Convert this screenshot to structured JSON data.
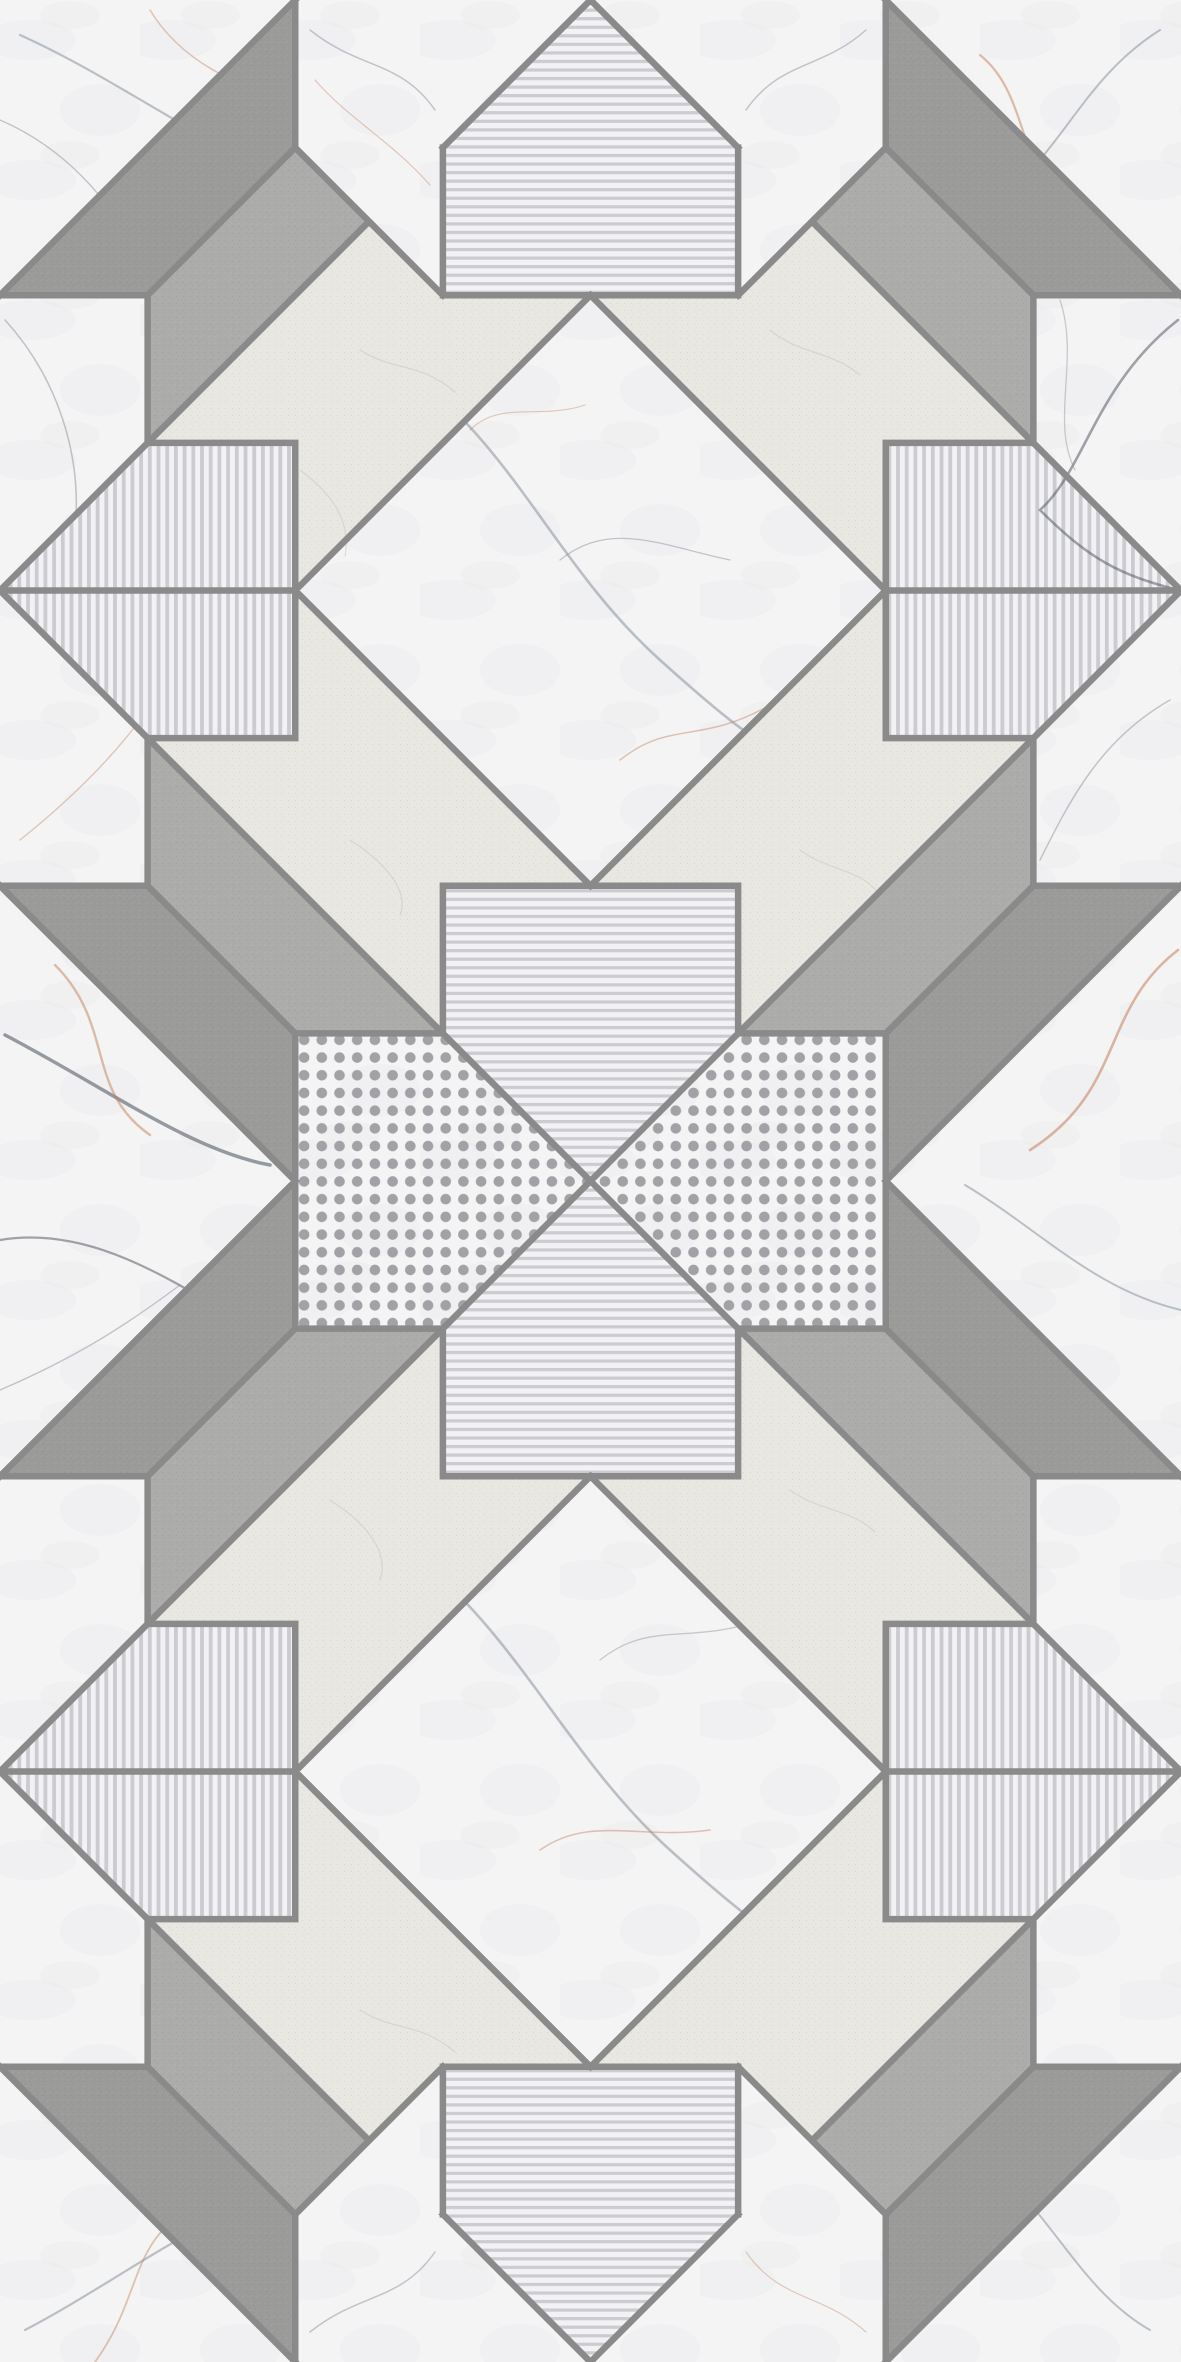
{
  "meta": {
    "description": "Geometric patchwork ceramic tile design: marble, greige stone, speckled gray bands, stripes and dots",
    "canvas": {
      "width": 1181,
      "height": 2362
    }
  },
  "palette": {
    "border": "#8a8a8a",
    "marble_white": "#f4f4f5",
    "stone_dark": "#9b9b9a",
    "stone_medium": "#acacab",
    "greige": "#e9e7e1",
    "stripe_bg": "#f2f2f4",
    "stripe_bar": "#cbcbd1",
    "dot_fill": "#a2a2a6",
    "vein_slate": "#7e8a95",
    "vein_dark": "#474f59",
    "vein_orange": "#c4805a",
    "crack": "#d3cfc4"
  },
  "pattern": {
    "unit": 147.625,
    "border_width": 6.5,
    "textures": {
      "white": {
        "fill": "#f4f4f5",
        "overlays": [
          "marble"
        ]
      },
      "dark": {
        "fill": "#9b9b9a",
        "overlays": [
          "grain"
        ]
      },
      "medium": {
        "fill": "#acacab",
        "overlays": [
          "grain"
        ]
      },
      "greige": {
        "fill": "#e9e7e1",
        "overlays": [
          "grain"
        ]
      },
      "hstripes": {
        "fill": "stripeH",
        "overlays": []
      },
      "vstripes": {
        "fill": "stripeV",
        "overlays": []
      },
      "dots": {
        "fill": "#f4f4f5",
        "overlays": [
          "marble",
          "dotsP"
        ]
      }
    },
    "defs": {
      "stripeH": {
        "w": 10,
        "h": 8.55,
        "bar": [
          0,
          0,
          10,
          3.2
        ]
      },
      "stripeV": {
        "w": 8.7,
        "h": 10,
        "bar": [
          0,
          0,
          3.8,
          10
        ]
      },
      "dotsP": {
        "size": 17.7,
        "r": 5.3,
        "x": 295.25,
        "y": 1031
      },
      "grain": {
        "size": 7,
        "cells": [
          [
            1,
            2,
            "rgba(30,30,30,0.085)"
          ],
          [
            5,
            0,
            "rgba(255,255,255,0.10)"
          ],
          [
            3,
            5,
            "rgba(30,30,30,0.05)"
          ],
          [
            0,
            6,
            "rgba(255,255,255,0.07)"
          ]
        ]
      },
      "marble": {
        "w": 140,
        "h": 140,
        "blobs": [
          [
            30,
            40,
            46,
            20,
            "rgba(158,168,178,0.055)"
          ],
          [
            100,
            110,
            40,
            26,
            "rgba(158,168,178,0.045)"
          ],
          [
            70,
            15,
            30,
            14,
            "rgba(190,160,140,0.04)"
          ]
        ]
      }
    },
    "regions": [
      {
        "name": "corner-marble",
        "tex": "white",
        "mirror": true,
        "pts": [
          [
            0,
            0
          ],
          [
            2,
            0
          ],
          [
            0,
            2
          ]
        ]
      },
      {
        "name": "dark-band-top",
        "tex": "dark",
        "mirror": true,
        "pts": [
          [
            2,
            0
          ],
          [
            2,
            1
          ],
          [
            1,
            2
          ],
          [
            0,
            2
          ]
        ]
      },
      {
        "name": "marble-flank-top",
        "tex": "white",
        "mirror": true,
        "pts": [
          [
            2,
            0
          ],
          [
            4,
            0
          ],
          [
            3,
            1
          ],
          [
            3,
            2
          ],
          [
            2,
            1
          ]
        ]
      },
      {
        "name": "pentagon-top",
        "tex": "hstripes",
        "mirror": false,
        "pts": [
          [
            4,
            0
          ],
          [
            5,
            1
          ],
          [
            5,
            2
          ],
          [
            3,
            2
          ],
          [
            3,
            1
          ]
        ]
      },
      {
        "name": "medium-band-top",
        "tex": "medium",
        "mirror": true,
        "pts": [
          [
            2,
            1
          ],
          [
            2.5,
            1.5
          ],
          [
            1,
            3
          ],
          [
            1,
            2
          ]
        ]
      },
      {
        "name": "marble-edge-upper",
        "tex": "white",
        "mirror": true,
        "pts": [
          [
            0,
            2
          ],
          [
            1,
            2
          ],
          [
            1,
            3
          ],
          [
            0,
            4
          ]
        ]
      },
      {
        "name": "pentagon-side",
        "tex": "vstripes",
        "mirror": true,
        "pts": [
          [
            0,
            4
          ],
          [
            1,
            3
          ],
          [
            2,
            3
          ],
          [
            2,
            5
          ],
          [
            1,
            5
          ]
        ]
      },
      {
        "name": "greige-chevron-top",
        "tex": "greige",
        "mirror": true,
        "pts": [
          [
            2.5,
            1.5
          ],
          [
            3,
            2
          ],
          [
            4,
            2
          ],
          [
            2,
            4
          ],
          [
            2,
            3
          ],
          [
            1,
            3
          ]
        ]
      },
      {
        "name": "marble-diamond",
        "tex": "white",
        "mirror": false,
        "pts": [
          [
            4,
            2
          ],
          [
            6,
            4
          ],
          [
            4,
            6
          ],
          [
            2,
            4
          ]
        ]
      },
      {
        "name": "marble-edge-lower",
        "tex": "white",
        "mirror": true,
        "pts": [
          [
            0,
            6
          ],
          [
            1,
            6
          ],
          [
            1,
            5
          ],
          [
            0,
            4
          ]
        ]
      },
      {
        "name": "medium-band-bot",
        "tex": "medium",
        "mirror": true,
        "pts": [
          [
            1,
            5
          ],
          [
            3,
            7
          ],
          [
            2,
            7
          ],
          [
            1,
            6
          ]
        ]
      },
      {
        "name": "greige-chevron-bot",
        "tex": "greige",
        "mirror": true,
        "pts": [
          [
            1,
            5
          ],
          [
            2,
            5
          ],
          [
            2,
            4
          ],
          [
            4,
            6
          ],
          [
            3,
            6
          ],
          [
            3,
            7
          ]
        ]
      },
      {
        "name": "dark-band-bot",
        "tex": "dark",
        "mirror": true,
        "pts": [
          [
            2,
            8
          ],
          [
            2,
            7
          ],
          [
            1,
            6
          ],
          [
            0,
            6
          ]
        ]
      },
      {
        "name": "corner-marble-bot",
        "tex": "white",
        "mirror": true,
        "pts": [
          [
            0,
            6
          ],
          [
            2,
            8
          ],
          [
            0,
            8
          ]
        ]
      },
      {
        "name": "dotted-patch",
        "tex": "dots",
        "mirror": true,
        "pts": [
          [
            2,
            7
          ],
          [
            3,
            7
          ],
          [
            4,
            8
          ],
          [
            2,
            8
          ]
        ]
      },
      {
        "name": "pentagon-bottom",
        "tex": "hstripes",
        "mirror": false,
        "pts": [
          [
            4,
            8
          ],
          [
            5,
            7
          ],
          [
            5,
            6
          ],
          [
            3,
            6
          ],
          [
            3,
            7
          ]
        ]
      }
    ],
    "borders": {
      "verticals": [
        [
          2,
          0,
          1
        ],
        [
          3,
          1,
          2
        ],
        [
          1,
          2,
          3
        ],
        [
          2,
          3,
          5
        ],
        [
          1,
          5,
          6
        ],
        [
          3,
          6,
          7
        ],
        [
          2,
          7,
          8
        ]
      ],
      "horizontals": [
        [
          2,
          0,
          1
        ],
        [
          2,
          3,
          4
        ],
        [
          3,
          1,
          2
        ],
        [
          4,
          0,
          2
        ],
        [
          5,
          1,
          2
        ],
        [
          6,
          0,
          1
        ],
        [
          6,
          3,
          4
        ],
        [
          7,
          2,
          3
        ]
      ],
      "diagonals": [
        [
          [
            2,
            0
          ],
          [
            0,
            2
          ]
        ],
        [
          [
            2,
            1
          ],
          [
            1,
            2
          ]
        ],
        [
          [
            4,
            0
          ],
          [
            3,
            1
          ]
        ],
        [
          [
            2.5,
            1.5
          ],
          [
            0,
            4
          ]
        ],
        [
          [
            4,
            2
          ],
          [
            2,
            4
          ]
        ],
        [
          [
            2,
            1
          ],
          [
            3,
            2
          ]
        ],
        [
          [
            2,
            4
          ],
          [
            4,
            6
          ]
        ],
        [
          [
            0,
            4
          ],
          [
            4,
            8
          ]
        ],
        [
          [
            1,
            6
          ],
          [
            2,
            7
          ]
        ],
        [
          [
            0,
            6
          ],
          [
            2,
            8
          ]
        ]
      ]
    },
    "clips": {
      "cornerTL": [
        [
          0,
          0
        ],
        [
          295.25,
          0
        ],
        [
          0,
          295.25
        ]
      ],
      "cornerTR": [
        [
          1181,
          0
        ],
        [
          885.75,
          0
        ],
        [
          1181,
          295.25
        ]
      ],
      "diamondTop": [
        [
          590.5,
          295.25
        ],
        [
          885.75,
          590.5
        ],
        [
          590.5,
          885.75
        ],
        [
          295.25,
          590.5
        ]
      ],
      "leftSeam": [
        [
          0,
          885.75
        ],
        [
          295.25,
          1181
        ],
        [
          0,
          1476.25
        ]
      ],
      "rightSeam": [
        [
          1181,
          885.75
        ],
        [
          885.75,
          1181
        ],
        [
          1181,
          1476.25
        ]
      ],
      "leftMid": [
        [
          0,
          295.25
        ],
        [
          147.6,
          295.25
        ],
        [
          147.6,
          442.9
        ],
        [
          0,
          590.5
        ],
        [
          147.6,
          738.1
        ],
        [
          147.6,
          885.75
        ],
        [
          0,
          885.75
        ]
      ],
      "rightMid": [
        [
          1181,
          295.25
        ],
        [
          1033.4,
          295.25
        ],
        [
          1033.4,
          442.9
        ],
        [
          885.75,
          590.5
        ],
        [
          1033.4,
          738.1
        ],
        [
          1033.4,
          885.75
        ],
        [
          1181,
          885.75
        ]
      ],
      "diamondBottom": [
        [
          590.5,
          1476.25
        ],
        [
          885.75,
          1771.5
        ],
        [
          590.5,
          2066.75
        ],
        [
          295.25,
          1771.5
        ]
      ],
      "cornerBL": [
        [
          0,
          2362
        ],
        [
          295.25,
          2362
        ],
        [
          0,
          2066.75
        ]
      ],
      "cornerBR": [
        [
          1181,
          2362
        ],
        [
          885.75,
          2362
        ],
        [
          1181,
          2066.75
        ]
      ]
    },
    "veins": [
      {
        "clip": "cornerTL",
        "d": "M 20 35 C 120 80 210 150 292 178",
        "c": "slate",
        "w": 2.2,
        "o": 0.5
      },
      {
        "clip": "cornerTL",
        "d": "M 0 120 C 70 150 120 210 150 278",
        "c": "slate",
        "w": 1.4,
        "o": 0.45
      },
      {
        "clip": "cornerTL",
        "d": "M 150 10 C 180 60 240 90 288 96",
        "c": "orange",
        "w": 1.6,
        "o": 0.4
      },
      {
        "clip": "cornerTR",
        "d": "M 1160 30 C 1080 80 1060 160 990 205",
        "c": "slate",
        "w": 2.0,
        "o": 0.5
      },
      {
        "clip": "cornerTR",
        "d": "M 980 55 C 1030 95 1015 170 1075 215",
        "c": "orange",
        "w": 2.2,
        "o": 0.5
      },
      {
        "clip": "diamondTop",
        "d": "M 420 380 C 520 460 560 570 660 660 S 760 740 800 760",
        "c": "slate",
        "w": 2.6,
        "o": 0.5
      },
      {
        "clip": "diamondTop",
        "d": "M 560 560 C 610 520 660 545 730 560",
        "c": "slate",
        "w": 1.3,
        "o": 0.45
      },
      {
        "clip": "diamondTop",
        "d": "M 620 760 C 670 720 700 745 770 705",
        "c": "orange",
        "w": 1.5,
        "o": 0.45
      },
      {
        "clip": "diamondTop",
        "d": "M 470 430 C 500 400 540 420 585 405",
        "c": "orange",
        "w": 1.1,
        "o": 0.4
      },
      {
        "clip": "leftSeam",
        "d": "M 5 1035 C 110 1090 190 1150 270 1165",
        "c": "dark",
        "w": 3.5,
        "o": 0.55
      },
      {
        "clip": "leftSeam",
        "d": "M 0 1240 C 90 1225 170 1280 240 1320",
        "c": "dark",
        "w": 2.2,
        "o": 0.5
      },
      {
        "clip": "leftSeam",
        "d": "M 55 965 C 115 1025 85 1090 150 1135",
        "c": "orange",
        "w": 2.4,
        "o": 0.5
      },
      {
        "clip": "leftSeam",
        "d": "M 0 1390 C 70 1360 120 1330 180 1285",
        "c": "slate",
        "w": 1.4,
        "o": 0.45
      },
      {
        "clip": "rightSeam",
        "d": "M 1178 950 C 1100 1010 1125 1090 1030 1150",
        "c": "orange",
        "w": 2.6,
        "o": 0.55
      },
      {
        "clip": "rightSeam",
        "d": "M 1181 1310 C 1095 1290 1040 1230 965 1185",
        "c": "slate",
        "w": 2.0,
        "o": 0.5
      },
      {
        "clip": "rightMid",
        "d": "M 1178 320 C 1095 385 1085 470 1040 510 C 1090 560 1120 575 1178 590",
        "c": "dark",
        "w": 2.6,
        "o": 0.5
      },
      {
        "clip": "rightMid",
        "d": "M 1060 300 C 1080 360 1050 420 1075 470",
        "c": "slate",
        "w": 1.3,
        "o": 0.4
      },
      {
        "clip": "rightMid",
        "d": "M 1170 700 C 1100 740 1070 800 1040 860",
        "c": "slate",
        "w": 1.5,
        "o": 0.45
      },
      {
        "clip": "leftMid",
        "d": "M 5 320 C 60 380 90 470 70 560",
        "c": "slate",
        "w": 1.6,
        "o": 0.45
      },
      {
        "clip": "leftMid",
        "d": "M 20 840 C 70 800 110 760 140 720",
        "c": "orange",
        "w": 1.4,
        "o": 0.4
      },
      {
        "clip": "diamondBottom",
        "d": "M 420 1560 C 520 1640 570 1760 670 1850 S 770 1930 805 1950",
        "c": "slate",
        "w": 2.6,
        "o": 0.5
      },
      {
        "clip": "diamondBottom",
        "d": "M 540 1850 C 590 1815 640 1840 710 1830",
        "c": "orange",
        "w": 1.6,
        "o": 0.45
      },
      {
        "clip": "diamondBottom",
        "d": "M 600 1660 C 650 1620 690 1645 760 1620",
        "c": "slate",
        "w": 1.3,
        "o": 0.4
      },
      {
        "clip": "cornerBL",
        "d": "M 25 2330 C 120 2280 200 2215 290 2190",
        "c": "slate",
        "w": 2.2,
        "o": 0.5
      },
      {
        "clip": "cornerBL",
        "d": "M 95 2362 C 140 2300 130 2250 180 2215",
        "c": "orange",
        "w": 1.8,
        "o": 0.45
      },
      {
        "clip": "cornerBR",
        "d": "M 1150 2330 C 1080 2290 1050 2210 990 2165",
        "c": "slate",
        "w": 2.0,
        "o": 0.5
      },
      {
        "d": "M 310 30 C 360 70 400 60 435 110",
        "c": "slate",
        "w": 1.5,
        "o": 0.45
      },
      {
        "d": "M 315 80 C 350 120 390 140 430 185",
        "c": "orange",
        "w": 1.2,
        "o": 0.4
      },
      {
        "d": "M 866 30 C 821 70 781 60 746 110",
        "c": "slate",
        "w": 1.5,
        "o": 0.45
      },
      {
        "d": "M 310 2332 C 360 2292 400 2302 435 2252",
        "c": "slate",
        "w": 1.5,
        "o": 0.45
      },
      {
        "d": "M 746 2252 C 781 2302 821 2292 866 2332",
        "c": "orange",
        "w": 1.2,
        "o": 0.4
      },
      {
        "d": "M 360 350 C 395 372 420 362 455 392",
        "c": "crack",
        "w": 1.2,
        "o": 0.8
      },
      {
        "d": "M 300 470 C 330 492 352 520 345 556",
        "c": "crack",
        "w": 1.2,
        "o": 0.7
      },
      {
        "d": "M 770 330 C 800 355 830 350 860 375",
        "c": "crack",
        "w": 1.2,
        "o": 0.75
      },
      {
        "d": "M 350 840 C 385 862 410 892 400 915",
        "c": "crack",
        "w": 1.2,
        "o": 0.75
      },
      {
        "d": "M 800 850 C 830 872 860 868 880 895",
        "c": "crack",
        "w": 1.2,
        "o": 0.7
      },
      {
        "d": "M 360 2010 C 395 2032 420 2022 455 2052",
        "c": "crack",
        "w": 1.2,
        "o": 0.75
      },
      {
        "d": "M 790 1490 C 820 1512 850 1508 875 1532",
        "c": "crack",
        "w": 1.2,
        "o": 0.7
      },
      {
        "d": "M 330 1500 C 365 1522 390 1552 380 1580",
        "c": "crack",
        "w": 1.2,
        "o": 0.75
      }
    ]
  }
}
